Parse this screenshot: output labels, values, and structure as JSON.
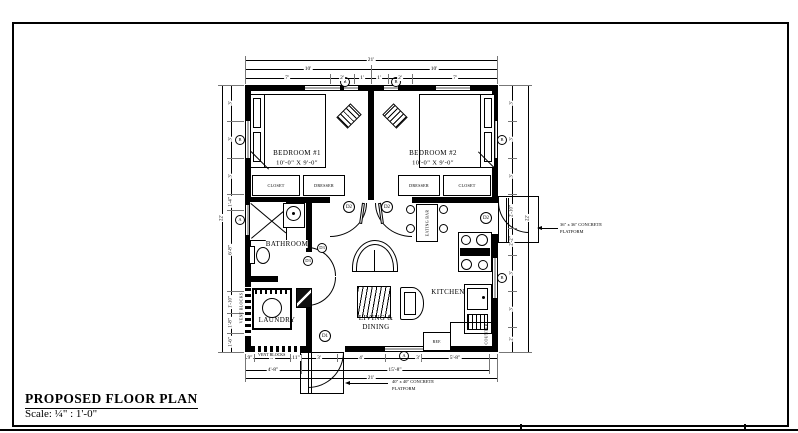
{
  "sheet": {
    "title": "PROPOSED FLOOR PLAN",
    "scale": "Scale: ¼\" : 1'-0\""
  },
  "rooms": {
    "bedroom1": {
      "name": "BEDROOM #1",
      "size": "10'-0\" X 9'-0\""
    },
    "bedroom2": {
      "name": "BEDROOM #2",
      "size": "10'-0\" X 9'-0\""
    },
    "bathroom": {
      "name": "BATHROOM"
    },
    "laundry": {
      "name": "LAUNDRY"
    },
    "kitchen": {
      "name": "KITCHEN"
    },
    "living": {
      "name1": "LIVING &",
      "name2": "DINING"
    }
  },
  "casework": {
    "closet1": "CLOSET",
    "dresser1": "DRESSER",
    "dresser2": "DRESSER",
    "closet2": "CLOSET",
    "eating_bar": "EATING BAR",
    "counter": "COUNTER",
    "ref": "REF."
  },
  "notes": {
    "vent_left": "VENT BLOCKS",
    "vent_bottom": "VENT BLOCKS",
    "platform_right": {
      "l1": "36\" x 36\" CONCRETE",
      "l2": "PLATFORM"
    },
    "platform_bottom": {
      "l1": "40\" x 40\" CONCRETE",
      "l2": "PLATFORM"
    }
  },
  "tags": {
    "d1": "D1",
    "d2": "D2",
    "d3": "D3",
    "a": "A",
    "b": "B"
  },
  "dims": {
    "top": {
      "overall": "21'",
      "half1": "10'",
      "half2": "10'",
      "chain": [
        "7'",
        "2'",
        "1'",
        "1'",
        "2'",
        "7'"
      ]
    },
    "bottom": {
      "overall": "21'",
      "mid1": "4'-8\"",
      "mid2": "15'-8\"",
      "chain": [
        "9\"",
        "3'",
        "11\"",
        "3'",
        "4'",
        "3'",
        "5'-8\""
      ]
    },
    "left": {
      "overall": "22'",
      "chain": [
        "3'",
        "3'",
        "3'",
        "1'-4\"",
        "6'-8\"",
        "1'-10\"",
        "1'-8\"",
        "1'-6\""
      ]
    },
    "right": {
      "overall": "22'",
      "chain": [
        "3'",
        "3'",
        "3'",
        "2'-10\"",
        "2'-2\"",
        "3'",
        "3'",
        "2'"
      ]
    }
  },
  "colors": {
    "ink": "#000000",
    "paper": "#ffffff"
  }
}
